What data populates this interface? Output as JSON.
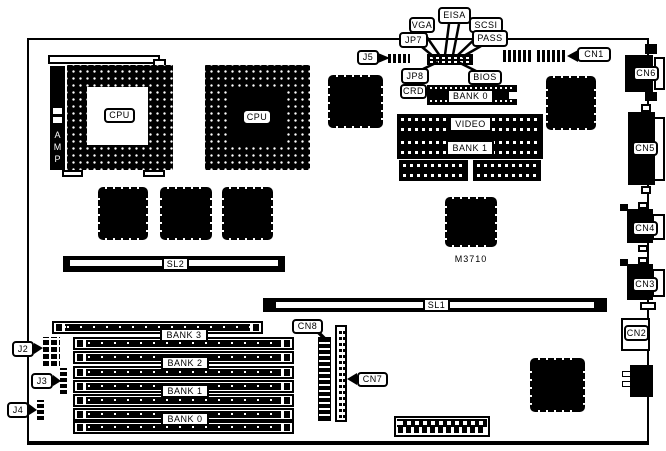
{
  "colors": {
    "ink": "#000000",
    "paper": "#ffffff"
  },
  "board": {
    "part_number": "M3710"
  },
  "labels": {
    "eisa": "EISA",
    "vga": "VGA",
    "scsi": "SCSI",
    "jp7": "JP7",
    "pass": "PASS",
    "j5": "J5",
    "jp8": "JP8",
    "bios": "BIOS",
    "crd": "CRD",
    "bank0_top": "BANK 0",
    "cn1": "CN1",
    "cn6": "CN6",
    "cn5": "CN5",
    "cn4": "CN4",
    "cn3": "CN3",
    "cn2": "CN2",
    "video": "VIDEO",
    "bank1_video": "BANK 1",
    "m3710": "M3710",
    "sl1": "SL1",
    "sl2": "SL2",
    "cpu_left": "CPU",
    "cpu_right": "CPU",
    "amp": "AMP",
    "j2": "J2",
    "j3": "J3",
    "j4": "J4",
    "cn8": "CN8",
    "cn7": "CN7",
    "bank3": "BANK 3",
    "bank2": "BANK 2",
    "bank1": "BANK 1",
    "bank0": "BANK 0"
  }
}
